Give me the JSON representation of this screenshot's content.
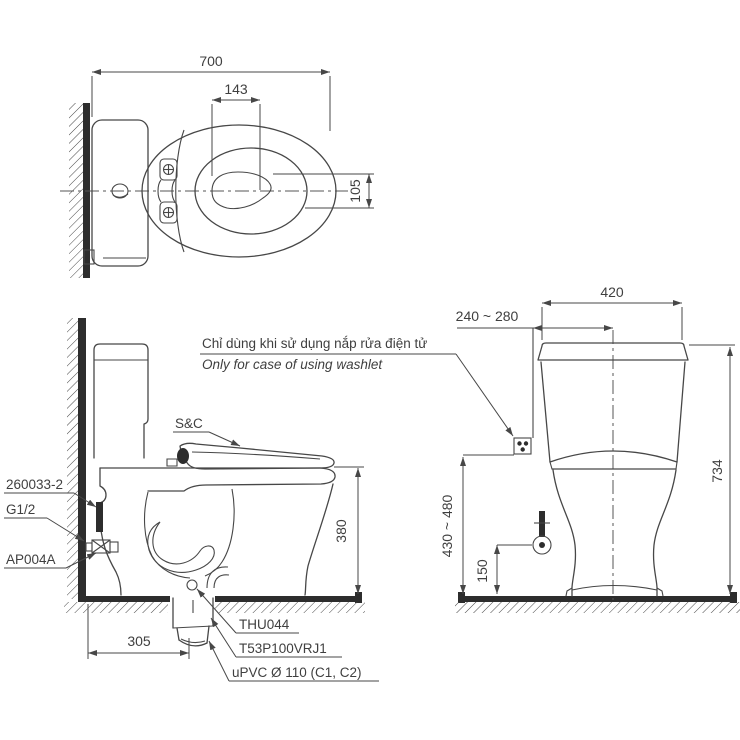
{
  "title": "Two-piece toilet installation dimension drawing",
  "views": {
    "top": {
      "overall_depth": "700",
      "water_width": "143",
      "water_depth": "105"
    },
    "side": {
      "note_line1": "Chỉ dùng khi sử dụng nắp rửa điện tử",
      "note_line2": "Only for case of using washlet",
      "seat_label": "S&C",
      "supply_part": "260033-2",
      "thread_size": "G1/2",
      "stop_valve_part": "AP004A",
      "rim_height": "380",
      "drain_offset": "305",
      "flange_part": "THU044",
      "joint_part": "T53P100VRJ1",
      "pipe_spec": "uPVC Ø 110 (C1, C2)"
    },
    "front": {
      "tank_width": "420",
      "outlet_offset": "240 ~ 280",
      "total_height": "734",
      "outlet_height_range": "430 ~ 480",
      "valve_height": "150"
    }
  },
  "colors": {
    "line": "#474747",
    "dark_fill": "#2d2d2d",
    "background": "#ffffff"
  }
}
